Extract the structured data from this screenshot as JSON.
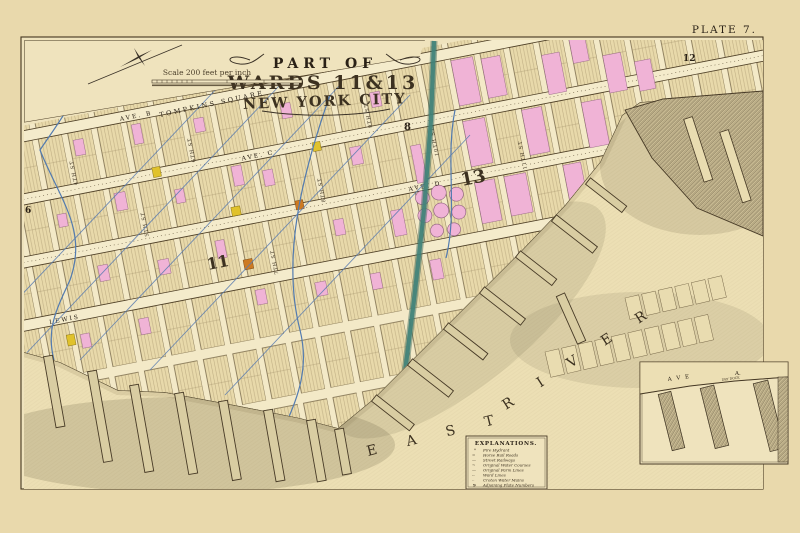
{
  "plate": {
    "label": "PLATE 7.",
    "adjoining_top": "12",
    "adjoining_left": "6",
    "adjoining_mid": "8"
  },
  "title": {
    "line1": "PART OF",
    "line2": "WARDS 11&13",
    "line3": "NEW YORK CITY"
  },
  "scale": {
    "text": "Scale 200 feet per inch"
  },
  "wards": {
    "left": "11",
    "right": "13"
  },
  "labels": {
    "square": "TOMPKINS SQUARE",
    "ave_b": "AVE.  B",
    "ave_c": "AVE.  C",
    "ave_d": "AVE.  D",
    "lewis": "LEWIS",
    "river_word1": "E A S T",
    "river_word2": "R I V E R",
    "cross_streets": [
      "4TH ST",
      "5TH ST",
      "6TH ST",
      "7TH ST",
      "8TH ST",
      "9TH ST",
      "10TH ST",
      "11TH ST"
    ]
  },
  "legend": {
    "title": "EXPLANATIONS.",
    "entries": [
      {
        "symbol": "*",
        "label": "Fire Hydrant"
      },
      {
        "symbol": "=",
        "label": "Horse Rail Roads"
      },
      {
        "symbol": "—",
        "label": "Street Railways"
      },
      {
        "symbol": "~",
        "label": "Original Water Courses"
      },
      {
        "symbol": "—",
        "label": "Original Farm Lines"
      },
      {
        "symbol": "--",
        "label": "Ward Lines"
      },
      {
        "symbol": "··",
        "label": "Croton Water Mains"
      },
      {
        "symbol": "9",
        "label": "Adjoining Plate Numbers"
      }
    ]
  },
  "inset": {
    "ave": "A V E",
    "block": "A.",
    "note": "DRY DOCK"
  },
  "colors": {
    "paper_outer": "#e9d9ac",
    "paper_inner": "#efe3bd",
    "block_fill": "#e8d9aa",
    "street_fill": "#f4ebcb",
    "ink": "#473a26",
    "ink_dark": "#241c12",
    "building_pink": "#f0b3d6",
    "building_yellow": "#e0c22c",
    "building_orange": "#cd7a22",
    "watercourse_teal": "#40837a",
    "farmline_blue": "#5a7cb0",
    "pier_fill": "#d9cda2"
  }
}
